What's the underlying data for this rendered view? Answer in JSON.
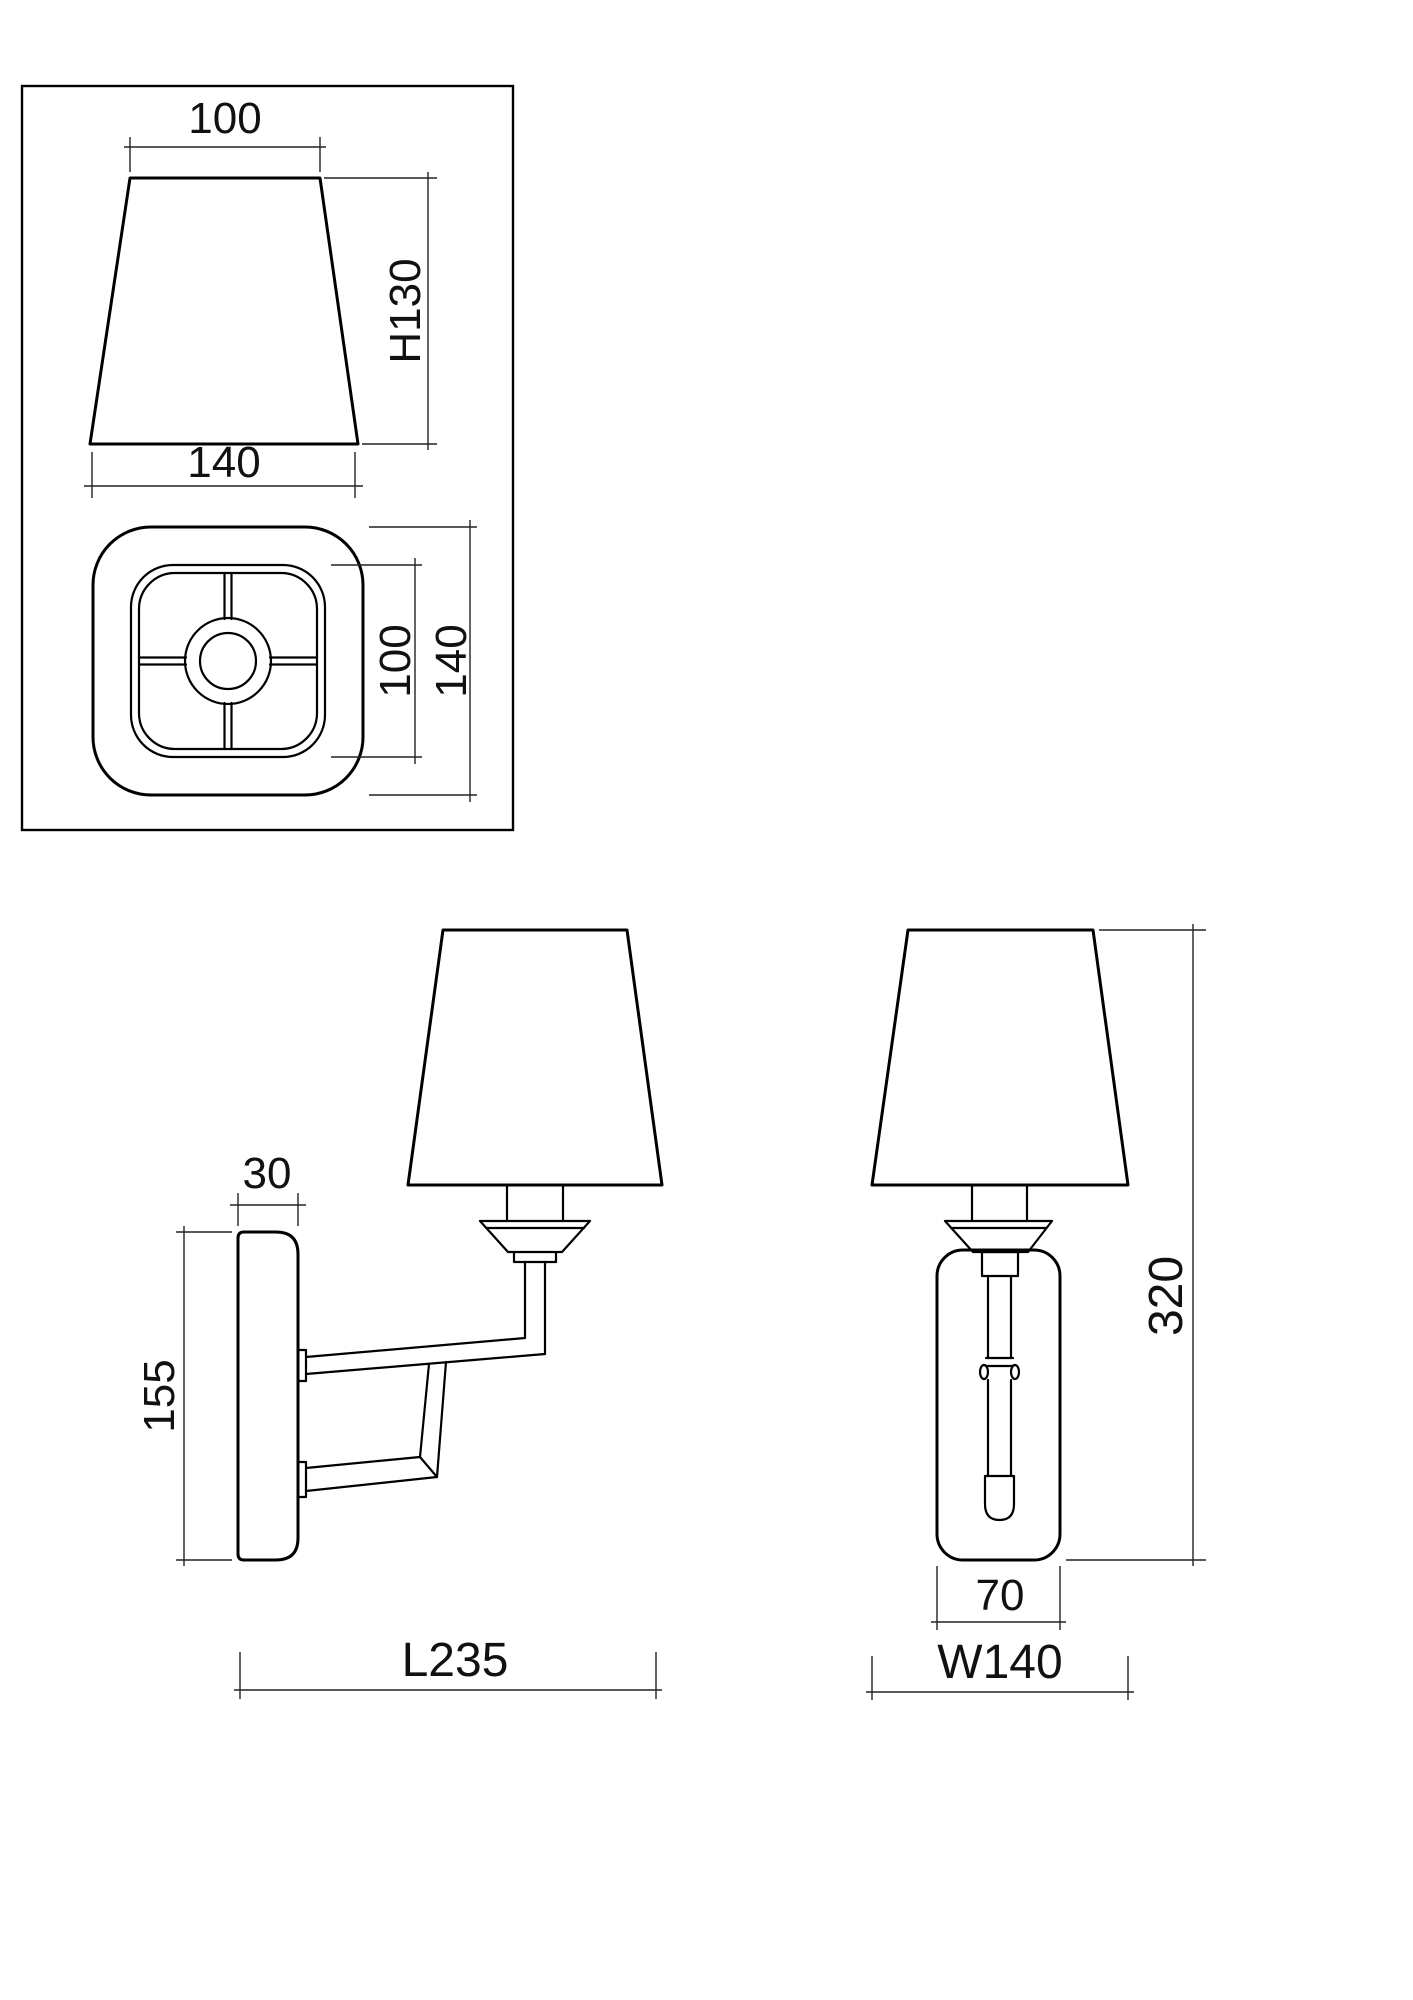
{
  "colors": {
    "line": "#000000",
    "dimension": "#222222",
    "background": "#ffffff"
  },
  "detail_box": {
    "shade_front_view": {
      "top_width": "100",
      "height": "H130",
      "bottom_width": "140"
    },
    "shade_top_view": {
      "inner_frame_size": "100",
      "outer_size": "140"
    }
  },
  "side_view": {
    "backplate_depth": "30",
    "backplate_height": "155",
    "overall_projection": "L235"
  },
  "front_view": {
    "overall_height": "320",
    "backplate_width": "70",
    "overall_width": "W140"
  }
}
